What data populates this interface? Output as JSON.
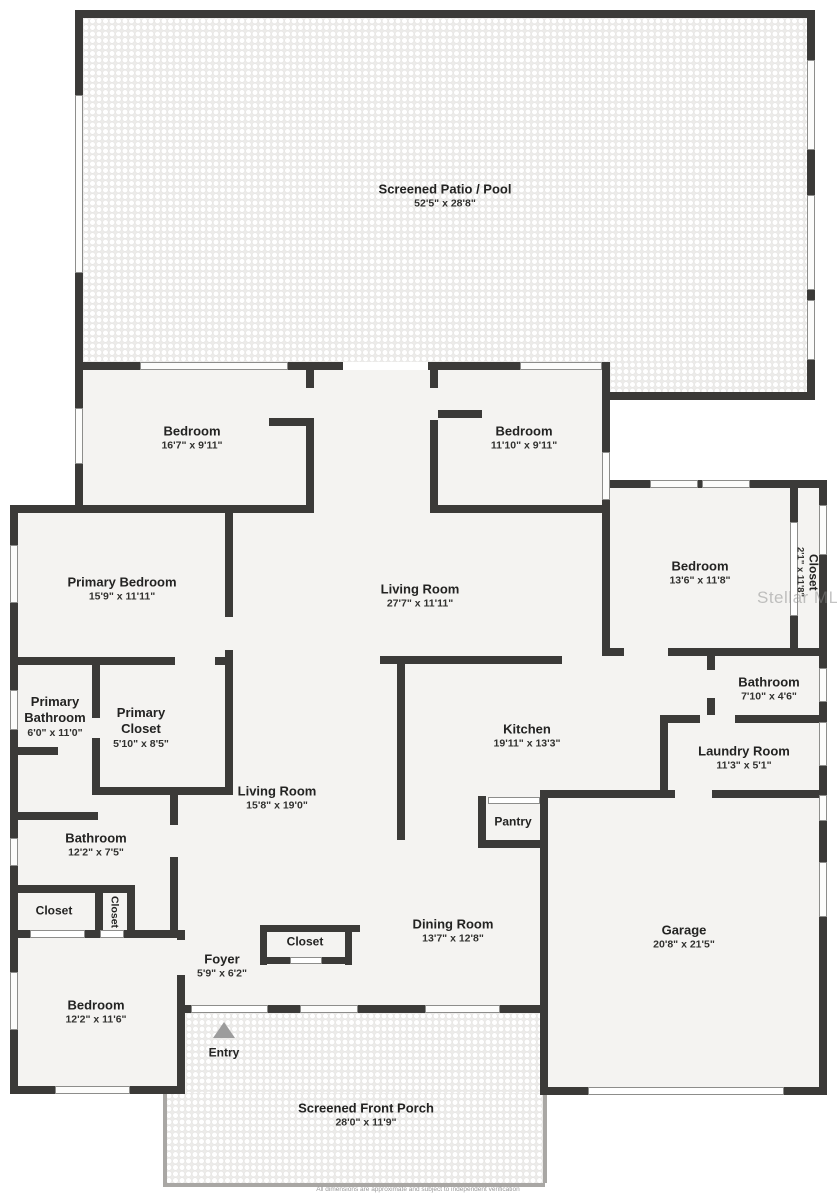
{
  "meta": {
    "watermark": "Stellar MLS",
    "disclaimer": "All dimensions are approximate and subject to independent verification"
  },
  "rooms": [
    {
      "id": "screened-patio",
      "name": "Screened Patio / Pool",
      "dims": "52'5\" x 28'8\""
    },
    {
      "id": "bedroom-top-left",
      "name": "Bedroom",
      "dims": "16'7\" x 9'11\""
    },
    {
      "id": "bedroom-top-right",
      "name": "Bedroom",
      "dims": "11'10\" x 9'11\""
    },
    {
      "id": "primary-bedroom",
      "name": "Primary Bedroom",
      "dims": "15'9\" x 11'11\""
    },
    {
      "id": "living-room-upper",
      "name": "Living Room",
      "dims": "27'7\" x 11'11\""
    },
    {
      "id": "bedroom-right",
      "name": "Bedroom",
      "dims": "13'6\" x 11'8\""
    },
    {
      "id": "closet-right",
      "name": "Closet",
      "dims": "2'1\" x 11'8\""
    },
    {
      "id": "bathroom-right",
      "name": "Bathroom",
      "dims": "7'10\" x 4'6\""
    },
    {
      "id": "laundry-room",
      "name": "Laundry Room",
      "dims": "11'3\" x 5'1\""
    },
    {
      "id": "kitchen",
      "name": "Kitchen",
      "dims": "19'11\" x 13'3\""
    },
    {
      "id": "primary-bathroom",
      "name": "Primary Bathroom",
      "dims": "6'0\" x 11'0\""
    },
    {
      "id": "primary-closet",
      "name": "Primary Closet",
      "dims": "5'10\" x 8'5\""
    },
    {
      "id": "living-room-lower",
      "name": "Living Room",
      "dims": "15'8\" x 19'0\""
    },
    {
      "id": "pantry",
      "name": "Pantry",
      "dims": ""
    },
    {
      "id": "bathroom-left",
      "name": "Bathroom",
      "dims": "12'2\" x 7'5\""
    },
    {
      "id": "closet-left",
      "name": "Closet",
      "dims": ""
    },
    {
      "id": "closet-left-vertical",
      "name": "Closet",
      "dims": ""
    },
    {
      "id": "bedroom-bottom-left",
      "name": "Bedroom",
      "dims": "12'2\" x 11'6\""
    },
    {
      "id": "foyer",
      "name": "Foyer",
      "dims": "5'9\" x 6'2\""
    },
    {
      "id": "closet-foyer",
      "name": "Closet",
      "dims": ""
    },
    {
      "id": "dining-room",
      "name": "Dining Room",
      "dims": "13'7\" x 12'8\""
    },
    {
      "id": "garage",
      "name": "Garage",
      "dims": "20'8\" x 21'5\""
    },
    {
      "id": "entry",
      "name": "Entry",
      "dims": ""
    },
    {
      "id": "front-porch",
      "name": "Screened Front Porch",
      "dims": "28'0\" x 11'9\""
    }
  ]
}
